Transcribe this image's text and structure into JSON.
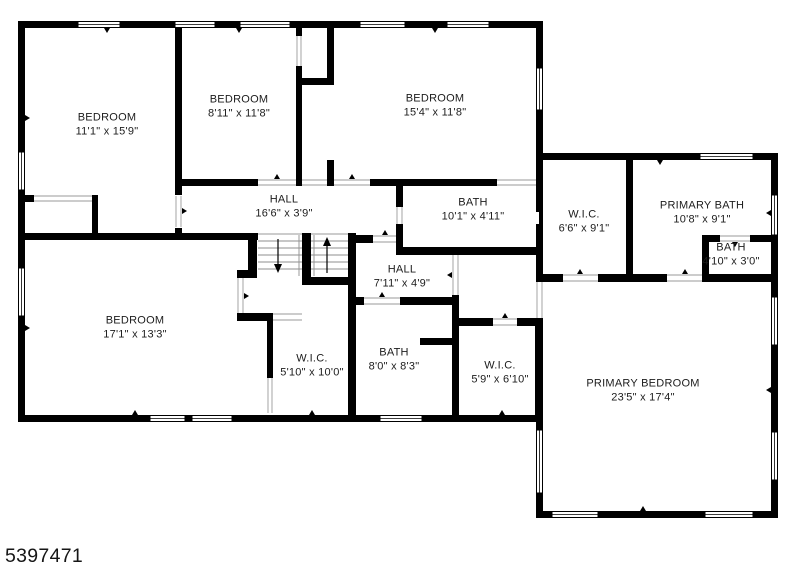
{
  "page": {
    "background_color": "#ffffff",
    "wall_color": "#000000",
    "text_color": "#1c1c1c"
  },
  "floorplan": {
    "id_number": "5397471",
    "rooms": [
      {
        "name": "BEDROOM",
        "dims": "11'1\" x 15'9\""
      },
      {
        "name": "BEDROOM",
        "dims": "8'11\" x 11'8\""
      },
      {
        "name": "BEDROOM",
        "dims": "15'4\" x 11'8\""
      },
      {
        "name": "HALL",
        "dims": "16'6\" x 3'9\""
      },
      {
        "name": "BATH",
        "dims": "10'1\" x 4'11\""
      },
      {
        "name": "W.I.C.",
        "dims": "6'6\" x 9'1\""
      },
      {
        "name": "PRIMARY BATH",
        "dims": "10'8\" x 9'1\""
      },
      {
        "name": "BATH",
        "dims": "4'10\" x 3'0\""
      },
      {
        "name": "BEDROOM",
        "dims": "17'1\" x 13'3\""
      },
      {
        "name": "HALL",
        "dims": "7'11\" x 4'9\""
      },
      {
        "name": "W.I.C.",
        "dims": "5'10\" x 10'0\""
      },
      {
        "name": "BATH",
        "dims": "8'0\" x 8'3\""
      },
      {
        "name": "W.I.C.",
        "dims": "5'9\" x 6'10\""
      },
      {
        "name": "PRIMARY BEDROOM",
        "dims": "23'5\" x 17'4\""
      }
    ]
  }
}
